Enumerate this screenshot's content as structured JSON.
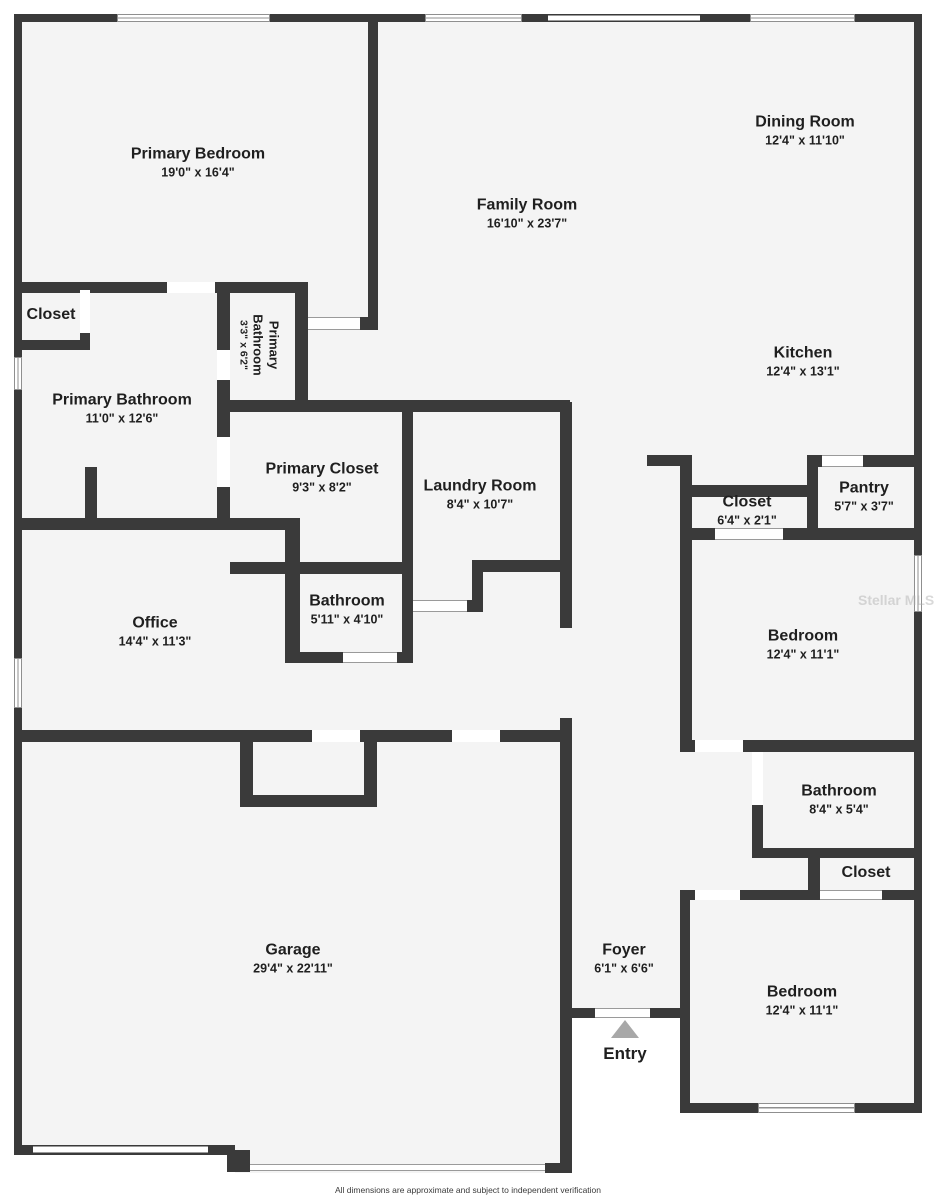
{
  "plan": {
    "rooms": [
      {
        "id": "primary-bedroom",
        "name": "Primary Bedroom",
        "dims": "19'0\" x 16'4\""
      },
      {
        "id": "family-room",
        "name": "Family Room",
        "dims": "16'10\" x 23'7\""
      },
      {
        "id": "dining-room",
        "name": "Dining Room",
        "dims": "12'4\" x 11'10\""
      },
      {
        "id": "kitchen",
        "name": "Kitchen",
        "dims": "12'4\" x 13'1\""
      },
      {
        "id": "closet-top-left",
        "name": "Closet",
        "dims": ""
      },
      {
        "id": "primary-bathroom-small",
        "name": "Primary Bathroom",
        "dims": "3'3\" x 6'2\""
      },
      {
        "id": "primary-bathroom",
        "name": "Primary Bathroom",
        "dims": "11'0\" x 12'6\""
      },
      {
        "id": "primary-closet",
        "name": "Primary Closet",
        "dims": "9'3\" x 8'2\""
      },
      {
        "id": "laundry-room",
        "name": "Laundry Room",
        "dims": "8'4\" x 10'7\""
      },
      {
        "id": "bathroom-middle",
        "name": "Bathroom",
        "dims": "5'11\" x 4'10\""
      },
      {
        "id": "office",
        "name": "Office",
        "dims": "14'4\" x 11'3\""
      },
      {
        "id": "closet-hall",
        "name": "Closet",
        "dims": "6'4\" x 2'1\""
      },
      {
        "id": "pantry",
        "name": "Pantry",
        "dims": "5'7\" x 3'7\""
      },
      {
        "id": "bedroom-upper",
        "name": "Bedroom",
        "dims": "12'4\" x 11'1\""
      },
      {
        "id": "bathroom-right",
        "name": "Bathroom",
        "dims": "8'4\" x 5'4\""
      },
      {
        "id": "closet-bedroom",
        "name": "Closet",
        "dims": ""
      },
      {
        "id": "bedroom-lower",
        "name": "Bedroom",
        "dims": "12'4\" x 11'1\""
      },
      {
        "id": "garage",
        "name": "Garage",
        "dims": "29'4\" x 22'11\""
      },
      {
        "id": "closet-garage",
        "name": "Closet",
        "dims": "6'3\" x 3'3\""
      },
      {
        "id": "foyer",
        "name": "Foyer",
        "dims": "6'1\" x 6'6\""
      }
    ],
    "entry_label": "Entry",
    "watermark": "Stellar MLS",
    "footer": "All dimensions are approximate and subject to independent verification",
    "colors": {
      "wall": "#3a3a3a",
      "floor": "#f4f4f4",
      "text": "#1f1f1f",
      "entry_arrow": "#a8a8a8"
    }
  }
}
